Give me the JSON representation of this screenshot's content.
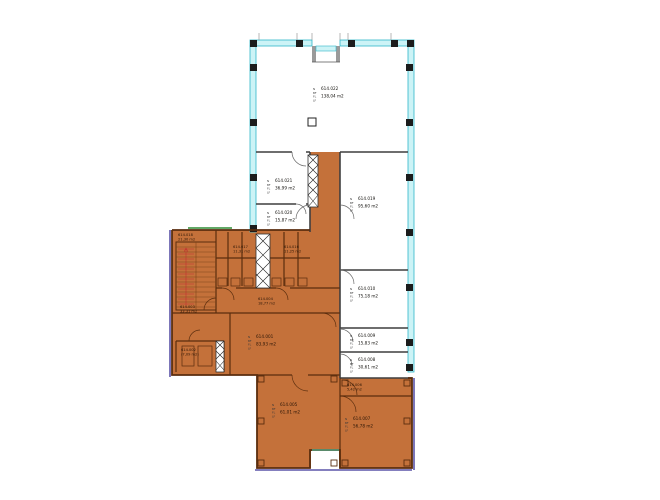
{
  "drawing": {
    "kind": "architectural-floor-plan",
    "stamp_prefixes": [
      "N",
      "BF",
      "FL",
      "LF"
    ],
    "area_unit": "m2"
  },
  "colors": {
    "highlight_fill": "#c4713a",
    "highlight_line": "#5a2d0e",
    "insulated_wall_band": "#ccf3f6",
    "insulated_wall_stroke": "#2fb6c9",
    "interior_wall": "#3f3f3f",
    "outer_accent": "#5b55a8",
    "stair_marking": "#c03030",
    "green_accent": "#2e8b33"
  },
  "rooms": [
    {
      "number": "614.022",
      "area": "138,04 m2",
      "zone": "white",
      "compact": false,
      "label": [
        313,
        90
      ],
      "bounds": [
        256,
        46,
        152,
        106
      ]
    },
    {
      "number": "614.021",
      "area": "36,99 m2",
      "zone": "white",
      "compact": false,
      "label": [
        267,
        182
      ],
      "bounds": [
        256,
        152,
        54,
        52
      ]
    },
    {
      "number": "614.020",
      "area": "15,87 m2",
      "zone": "white",
      "compact": false,
      "label": [
        267,
        214
      ],
      "bounds": [
        256,
        204,
        54,
        28
      ]
    },
    {
      "number": "614.019",
      "area": "95,60 m2",
      "zone": "white",
      "compact": false,
      "label": [
        350,
        200
      ],
      "bounds": [
        340,
        152,
        68,
        118
      ]
    },
    {
      "number": "614.010",
      "area": "75,18 m2",
      "zone": "white",
      "compact": false,
      "label": [
        350,
        290
      ],
      "bounds": [
        340,
        270,
        68,
        58
      ]
    },
    {
      "number": "614.009",
      "area": "15,83 m2",
      "zone": "white",
      "compact": false,
      "label": [
        350,
        337
      ],
      "bounds": [
        340,
        328,
        68,
        24
      ]
    },
    {
      "number": "614.008",
      "area": "30,61 m2",
      "zone": "white",
      "compact": false,
      "label": [
        350,
        361
      ],
      "bounds": [
        340,
        352,
        68,
        26
      ]
    },
    {
      "number": "614.018",
      "area": "21,30 m2",
      "zone": "highlight",
      "compact": true,
      "label": [
        178,
        236
      ],
      "bounds": [
        172,
        230,
        44,
        83
      ]
    },
    {
      "number": "614.017",
      "area": "11,31 m2",
      "zone": "highlight",
      "compact": true,
      "label": [
        233,
        248
      ],
      "bounds": [
        216,
        230,
        54,
        58
      ]
    },
    {
      "number": "614.016",
      "area": "11,25 m2",
      "zone": "highlight",
      "compact": true,
      "label": [
        284,
        248
      ],
      "bounds": [
        270,
        230,
        70,
        58
      ]
    },
    {
      "number": "614.004",
      "area": "18,77 m2",
      "zone": "highlight",
      "compact": true,
      "label": [
        258,
        300
      ],
      "bounds": [
        216,
        288,
        124,
        25
      ]
    },
    {
      "number": "614.003",
      "area": "33,31 m2",
      "zone": "highlight",
      "compact": true,
      "label": [
        180,
        308
      ],
      "bounds": [
        172,
        313,
        58,
        28
      ]
    },
    {
      "number": "614.001",
      "area": "83,93 m2",
      "zone": "highlight",
      "compact": false,
      "label": [
        248,
        338
      ],
      "bounds": [
        230,
        313,
        110,
        62
      ]
    },
    {
      "number": "614.002",
      "area": "(7,09 m2)",
      "zone": "highlight",
      "compact": true,
      "label": [
        181,
        351
      ],
      "bounds": [
        176,
        341,
        48,
        31
      ]
    },
    {
      "number": "614.005",
      "area": "61,01 m2",
      "zone": "highlight",
      "compact": false,
      "label": [
        272,
        406
      ],
      "bounds": [
        257,
        375,
        83,
        93
      ]
    },
    {
      "number": "614.006",
      "area": "5,42 m2",
      "zone": "highlight",
      "compact": true,
      "label": [
        347,
        386
      ],
      "bounds": [
        340,
        378,
        72,
        18
      ]
    },
    {
      "number": "614.007",
      "area": "56,78 m2",
      "zone": "highlight",
      "compact": false,
      "label": [
        345,
        420
      ],
      "bounds": [
        340,
        396,
        72,
        72
      ]
    }
  ]
}
